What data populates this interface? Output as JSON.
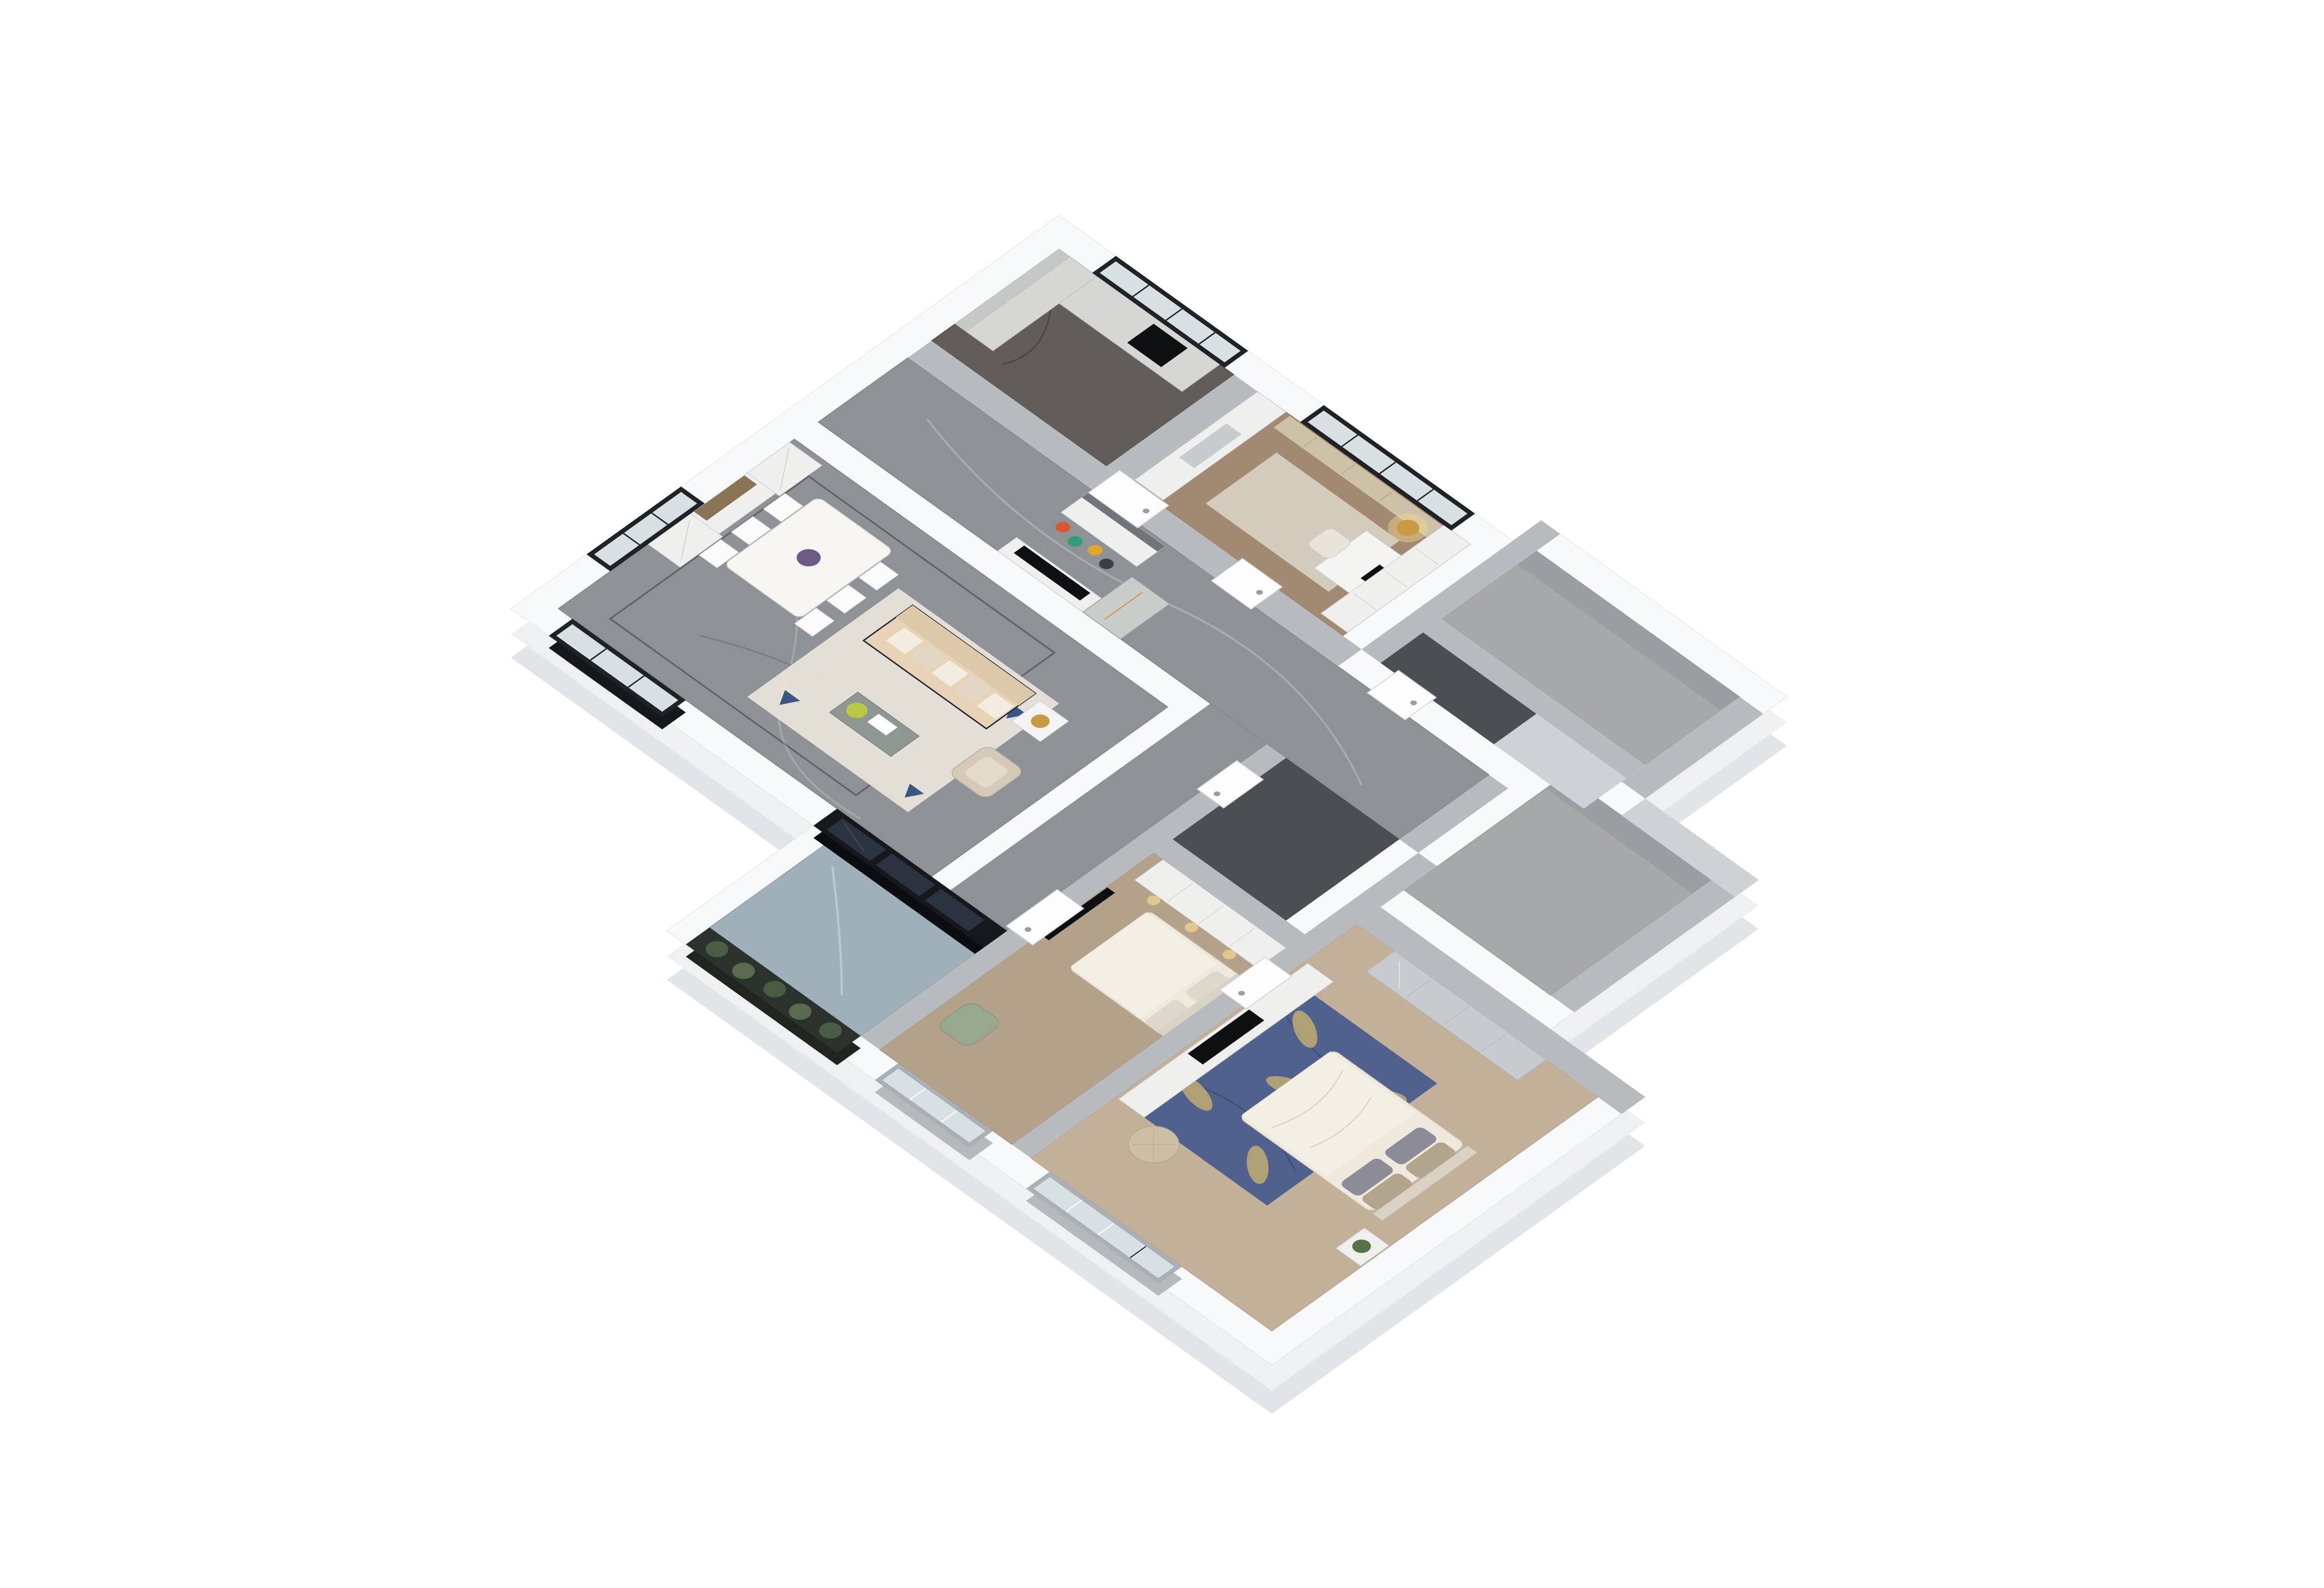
{
  "scene": {
    "title": "3D dollhouse-view apartment floor plan render",
    "background": "#ffffff",
    "view": "axonometric top-down, plan rotated ~45 degrees",
    "text_visible": "none"
  },
  "palette": {
    "background": "#ffffff",
    "outer_wall_top": "#f8f9fa",
    "outer_wall_side": "#eef0f2",
    "outer_wall_side_deep": "#e2e5e8",
    "outer_wall_edge": "#dfe2e4",
    "inner_wall_gray": "#b7bbbe",
    "inner_wall_gray_light": "#cfd2d4",
    "floor_marble_gray": "#8e9296",
    "floor_marble_kitchen": "#625d58",
    "floor_marble_dark": "#4b4e52",
    "floor_wood_study": "#a18a71",
    "floor_wood_bed2": "#b3a18a",
    "floor_wood_master": "#c2b099",
    "floor_balcony": "#9fb0ba",
    "floor_empty_room": "#a6a8aa",
    "floor_inlay": "#3a3d40",
    "glass_dark": "#16181c",
    "glass_pane_dark": "#2c3340",
    "glass_light": "#d8e0e4",
    "window_frame_dark": "#1f2226",
    "window_frame_light": "#a9afb4",
    "curtain": "#cdc1a8",
    "cabinet_white": "#eff0ee",
    "cabinet_seam": "#c9ccd0",
    "wood_counter": "#d6d7d4",
    "mirror": "#c6cbcf",
    "mural": "#8b7355",
    "sofa_body": "#e7d4b6",
    "sofa_back": "#dcc9a9",
    "sofa_trim": "#232738",
    "cushion_light": "#f3ece0",
    "cushion_shadow": "#e2d6c4",
    "armchair": "#d5c9b8",
    "rug_living": "#e8e4d9",
    "rug_study": "#d8d1c3",
    "rug_blue": "#50618e",
    "rug_blue_vein": "#3d4e7c",
    "rug_leaf": "#bfab72",
    "accent_blue": "#3a5683",
    "bed_linen": "#efe9dd",
    "duvet_light": "#f4efe5",
    "headboard": "#d8d1c4",
    "pillow_gray": "#8b8c97",
    "pillow_tan": "#b3a48e",
    "tv_black": "#0e0f11",
    "lamp_gold": "#c99a43",
    "lamp_glow": "#f5d88f",
    "plant_green": "#57714b",
    "coffee_table": "#8e9792",
    "table_flowers": "#b9c943",
    "chair_green": "#98a88e",
    "railing_green": "#2c332d",
    "planter_leaf_a": "#4a5c44",
    "planter_leaf_b": "#5a6b4e",
    "ottoman": "#cdbfa5",
    "centerpiece_purple": "#6b5a86",
    "shoe_red": "#d9572e",
    "shoe_teal": "#2e9e77",
    "shoe_yellow": "#e0a62a",
    "shoe_dark": "#3b3e45",
    "marble_vein_light": "#ffffff",
    "marble_vein_dark": "#3f4449"
  },
  "rooms": [
    {
      "id": "kitchen",
      "label": "Kitchen",
      "floor": "dark gray marble",
      "features": [
        "L-shaped light gray counters",
        "black cooktop",
        "black framed window"
      ]
    },
    {
      "id": "entry-hall",
      "label": "Entry Hall / Corridor",
      "floor": "gray veined marble",
      "features": [
        "shoe cabinet with heels on floor",
        "console with TV",
        "tall glass display cabinet",
        "white entry door"
      ]
    },
    {
      "id": "dining-room",
      "label": "Dining Room",
      "floor": "gray veined marble with dark inlay border",
      "features": [
        "two lattice wine cabinets",
        "landscape mural with birds",
        "white dining table",
        "six white cross-back chairs",
        "purple centerpiece"
      ]
    },
    {
      "id": "living-room",
      "label": "Living Room",
      "floor": "gray veined marble",
      "features": [
        "beige tufted sofa with navy trim",
        "striped cushions",
        "glass side table with gold lamp",
        "champagne leather armchair",
        "gray-green coffee table",
        "cream area rug with blue triangles"
      ]
    },
    {
      "id": "balcony",
      "label": "Balcony",
      "floor": "blue-gray marble",
      "features": [
        "black framed sliding glass doors",
        "dark planter railing with plants"
      ]
    },
    {
      "id": "study-bedroom",
      "label": "Study / Bedroom 3",
      "floor": "warm wood",
      "features": [
        "white wardrobe with mirror",
        "desk with monitor",
        "bookshelf wall",
        "gold floor lamp",
        "beige curtains",
        "black framed window"
      ]
    },
    {
      "id": "bathroom-a",
      "label": "Bathroom 1",
      "floor": "dark marble"
    },
    {
      "id": "bathroom-b",
      "label": "Bathroom 2",
      "floor": "dark marble"
    },
    {
      "id": "utility-room-a",
      "label": "Unfurnished room A",
      "floor": "bare gray concrete"
    },
    {
      "id": "utility-room-b",
      "label": "Unfurnished room B",
      "floor": "bare gray concrete"
    },
    {
      "id": "hallway",
      "label": "South Hallway",
      "floor": "gray veined marble"
    },
    {
      "id": "bedroom-2",
      "label": "Bedroom 2",
      "floor": "wood",
      "features": [
        "wall mounted TV",
        "lit white wardrobe row",
        "double bed with beige duvet",
        "sage green armchair",
        "window to balcony side"
      ]
    },
    {
      "id": "master-bedroom",
      "label": "Master Bedroom",
      "floor": "light wood",
      "features": [
        "blue leaf-pattern rug",
        "double bed with white duvet",
        "gray and tan pillows",
        "mirrored sliding wardrobe",
        "white TV cabinet row",
        "round leather ottoman",
        "bedside table with plant",
        "gray framed windows"
      ]
    }
  ],
  "furniture_ids": [
    "kitchen-counter",
    "cooktop",
    "shoe-cabinet",
    "entry-console-tv",
    "glass-display-cabinet",
    "wine-cabinet",
    "sideboard",
    "wall-mural",
    "dining-table",
    "dining-chair",
    "sofa",
    "sofa-cushion",
    "side-table",
    "table-lamp",
    "armchair",
    "coffee-table",
    "living-rug",
    "study-wardrobe",
    "study-rug",
    "desk",
    "desk-monitor",
    "desk-chair",
    "bookshelf",
    "floor-lamp",
    "curtain",
    "bed2-wardrobe",
    "bed2-bed",
    "bed2-tv",
    "green-armchair",
    "master-rug",
    "master-bed",
    "master-tv-cabinet",
    "master-wardrobe-mirror",
    "ottoman",
    "bedside-table",
    "balcony-planter",
    "window",
    "door"
  ]
}
